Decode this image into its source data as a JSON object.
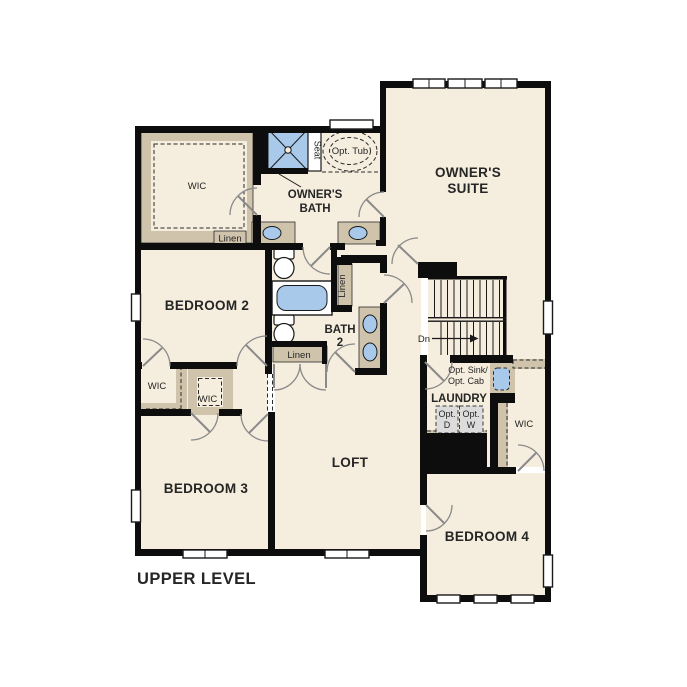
{
  "title": "UPPER LEVEL",
  "colors": {
    "background": "#ffffff",
    "floor": "#f5eddd",
    "wall": "#0d0d0d",
    "closet_tan": "#cfc3ab",
    "fixture_blue": "#a9c9ea",
    "appliance_gray": "#dcdcdc"
  },
  "rooms": {
    "owners_suite": [
      "OWNER'S",
      "SUITE"
    ],
    "owners_bath": [
      "OWNER'S",
      "BATH"
    ],
    "bedroom2": "BEDROOM 2",
    "bedroom3": "BEDROOM 3",
    "bedroom4": "BEDROOM 4",
    "loft": "LOFT",
    "laundry": "LAUNDRY",
    "bath2": [
      "BATH",
      "2"
    ]
  },
  "closets": {
    "owners_wic": "WIC",
    "bedroom2_wic": "WIC",
    "bedroom3_wic": "WIC",
    "bedroom4_wic": "WIC",
    "owners_linen": "Linen",
    "bath_linen": "Linen",
    "hall_linen": "Linen"
  },
  "fixtures": {
    "shower_seat": "Seat",
    "optional_tub": "Opt. Tub",
    "optional_sink_line1": "Opt. Sink/",
    "optional_sink_line2": "Opt. Cab",
    "optional_dryer": [
      "Opt.",
      "D"
    ],
    "optional_washer": [
      "Opt.",
      "W"
    ],
    "stairs_direction": "Dn"
  }
}
